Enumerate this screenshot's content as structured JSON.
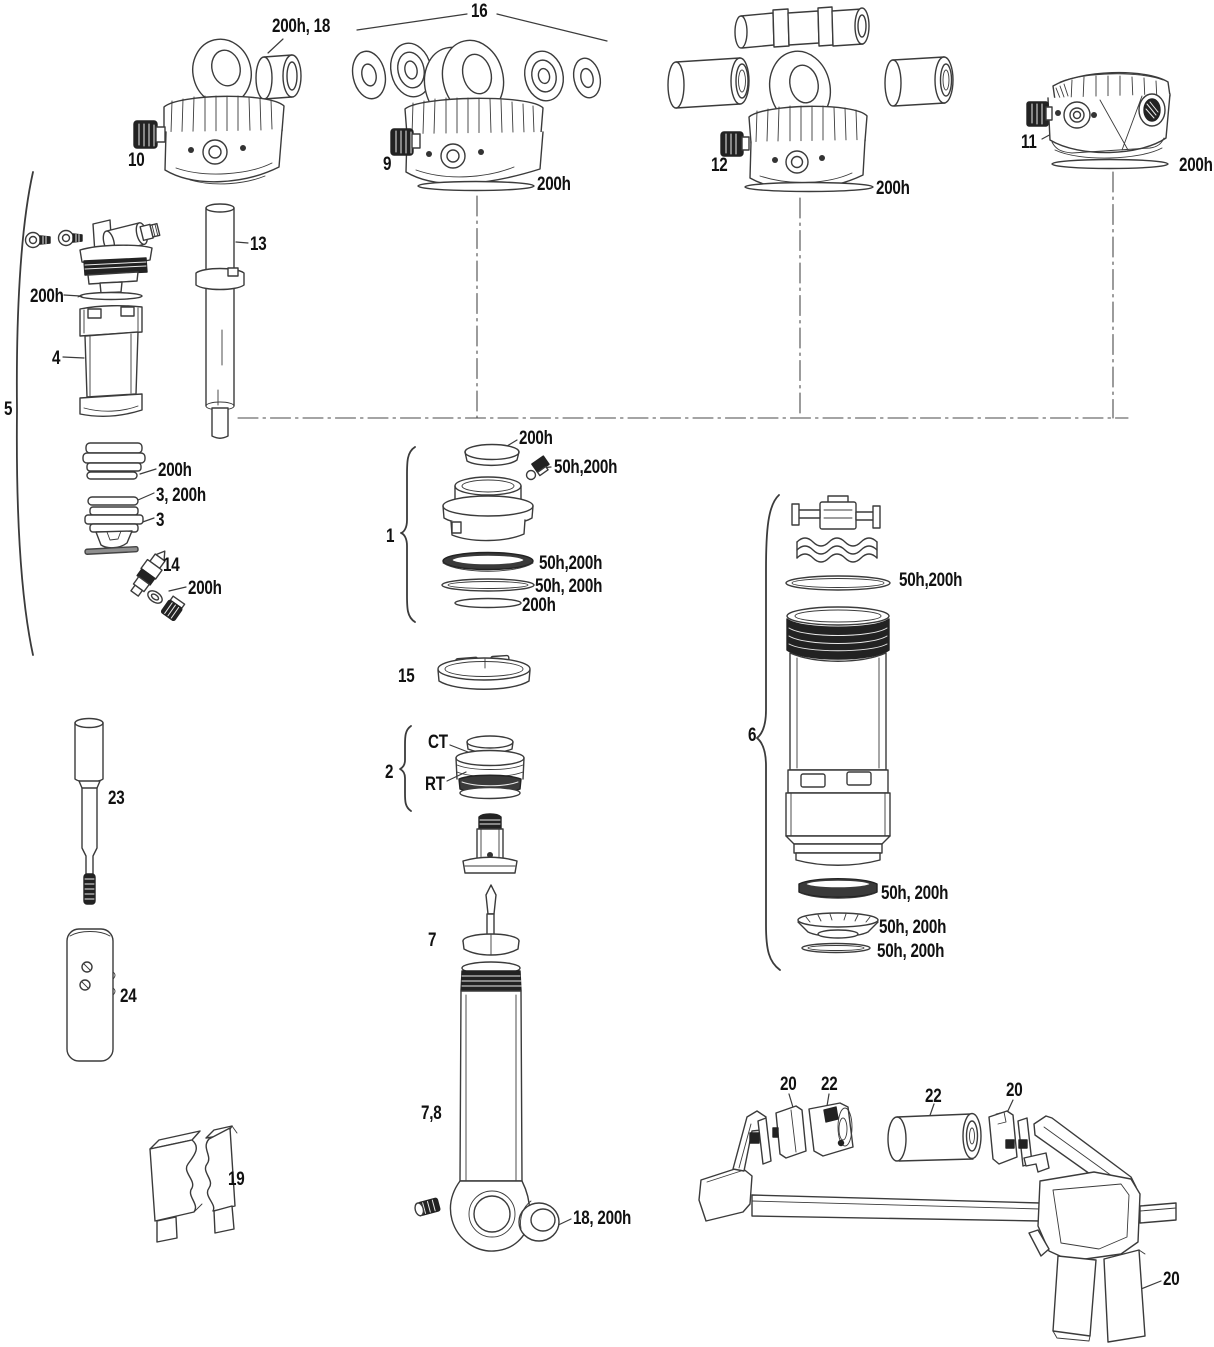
{
  "colors": {
    "line": "#3b3b3b",
    "dark_fill": "#222222",
    "background": "#ffffff",
    "text": "#111111"
  },
  "labels": {
    "bushing_18": "200h, 18",
    "group_16": "16",
    "part_10": "10",
    "part_9": "9",
    "ring_9": "200h",
    "part_12": "12",
    "ring_12": "200h",
    "part_11": "11",
    "ring_11": "200h",
    "part_13": "13",
    "air_top_seal": "200h",
    "part_4": "4",
    "group_5": "5",
    "seal_head_ring": "200h",
    "piston_ring_3": "3, 200h",
    "part_3": "3",
    "part_14": "14",
    "oring_14": "200h",
    "group_1": "1",
    "cap_1": "200h",
    "valve_1": "50h,200h",
    "glide_ring_1": "50h,200h",
    "oring_1": "50h, 200h",
    "ring_1": "200h",
    "part_15": "15",
    "group_2": "2",
    "ct": "CT",
    "rt": "RT",
    "group_6": "6",
    "oring_6": "50h,200h",
    "seal_6a": "50h, 200h",
    "seal_6b": "50h, 200h",
    "seal_6c": "50h, 200h",
    "part_23": "23",
    "part_24": "24",
    "part_19": "19",
    "part_7": "7",
    "part_7_8": "7,8",
    "bushing_7": "18, 200h",
    "tool_20_left": "20",
    "tool_22_left": "22",
    "tool_22_right": "22",
    "tool_20_right": "20",
    "tool_20_handle": "20"
  }
}
